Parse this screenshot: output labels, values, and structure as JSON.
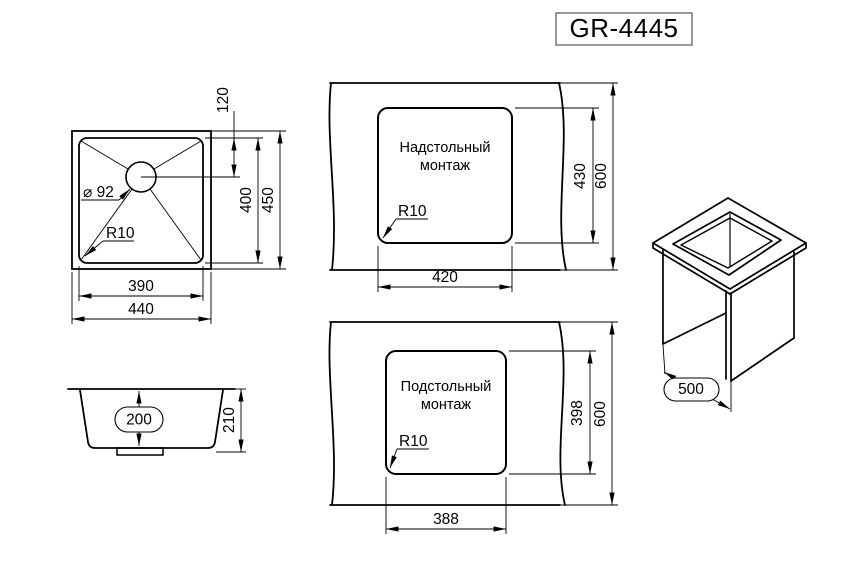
{
  "title": "GR-4445",
  "top_view": {
    "offset": "120",
    "inner_h": "400",
    "outer_h": "450",
    "inner_w": "390",
    "outer_w": "440",
    "diameter": "⌀ 92",
    "radius": "R10"
  },
  "side_view": {
    "inner_d": "200",
    "outer_d": "210"
  },
  "mount_top": {
    "line1": "Надстольный",
    "line2": "монтаж",
    "radius": "R10",
    "w": "420",
    "h": "430",
    "depth": "600"
  },
  "mount_under": {
    "line1": "Подстольный",
    "line2": "монтаж",
    "radius": "R10",
    "w": "388",
    "h": "398",
    "depth": "600"
  },
  "iso": {
    "width": "500"
  },
  "colors": {
    "line": "#000000",
    "background": "#ffffff",
    "title_border": "#777777"
  }
}
